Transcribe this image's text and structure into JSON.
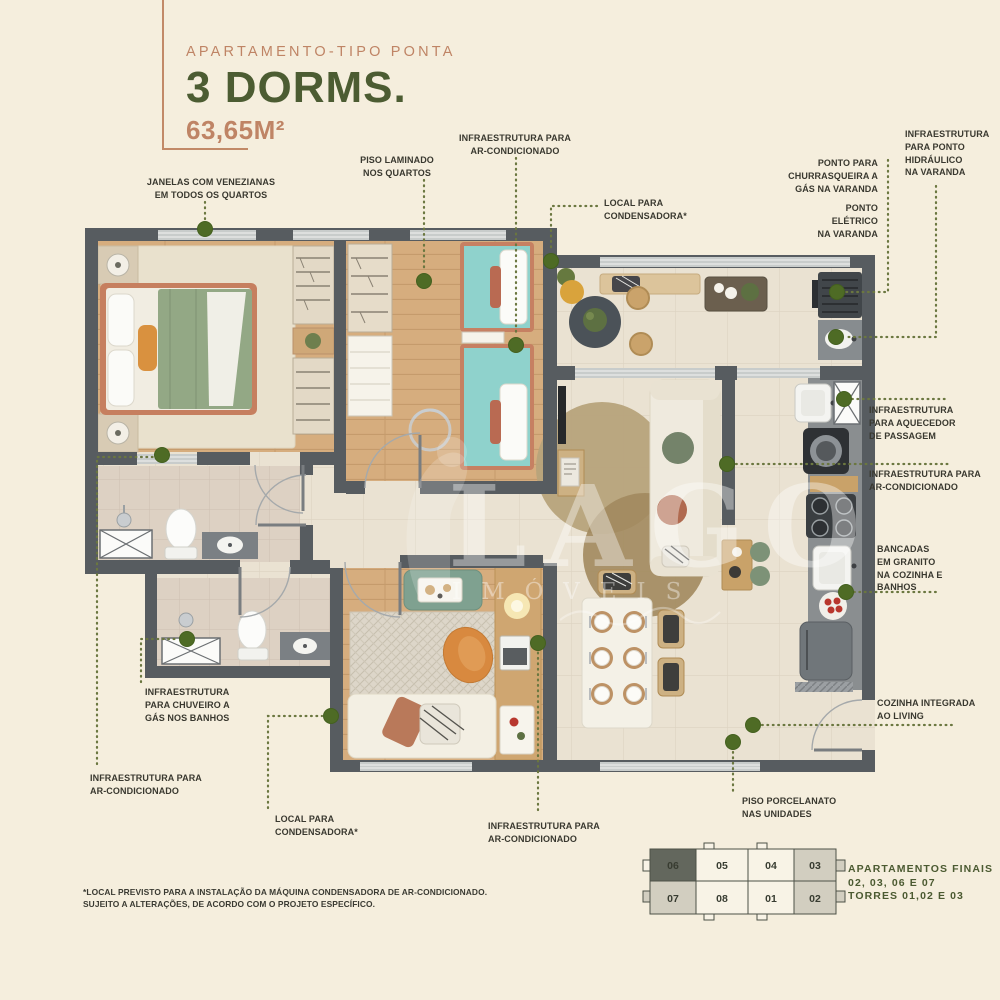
{
  "header": {
    "kicker": "APARTAMENTO-TIPO PONTA",
    "title": "3 DORMS.",
    "area": "63,65M²"
  },
  "callouts": {
    "janelas": {
      "lines": [
        "JANELAS COM VENEZIANAS",
        "EM TODOS OS QUARTOS"
      ]
    },
    "piso_laminado": {
      "lines": [
        "PISO LAMINADO",
        "NOS QUARTOS"
      ]
    },
    "infra_ar_top": {
      "lines": [
        "INFRAESTRUTURA PARA",
        "AR-CONDICIONADO"
      ]
    },
    "local_condensadora_top": {
      "lines": [
        "LOCAL PARA",
        "CONDENSADORA*"
      ]
    },
    "churrasqueira": {
      "lines": [
        "PONTO PARA",
        "CHURRASQUEIRA A",
        "GÁS NA VARANDA"
      ]
    },
    "ponto_eletrico": {
      "lines": [
        "PONTO",
        "ELÉTRICO",
        "NA VARANDA"
      ]
    },
    "hidraulico": {
      "lines": [
        "INFRAESTRUTURA",
        "PARA PONTO",
        "HIDRÁULICO",
        "NA VARANDA"
      ]
    },
    "aquecedor": {
      "lines": [
        "INFRAESTRUTURA",
        "PARA AQUECEDOR",
        "DE PASSAGEM"
      ]
    },
    "infra_ar_right": {
      "lines": [
        "INFRAESTRUTURA PARA",
        "AR-CONDICIONADO"
      ]
    },
    "bancadas": {
      "lines": [
        "BANCADAS",
        "EM GRANITO",
        "NA COZINHA E",
        "BANHOS"
      ]
    },
    "cozinha_integrada": {
      "lines": [
        "COZINHA INTEGRADA",
        "AO LIVING"
      ]
    },
    "piso_porcelanato": {
      "lines": [
        "PISO PORCELANATO",
        "NAS UNIDADES"
      ]
    },
    "chuveiro": {
      "lines": [
        "INFRAESTRUTURA",
        "PARA CHUVEIRO A",
        "GÁS NOS BANHOS"
      ]
    },
    "infra_ar_left": {
      "lines": [
        "INFRAESTRUTURA PARA",
        "AR-CONDICIONADO"
      ]
    },
    "local_condensadora_bottom": {
      "lines": [
        "LOCAL PARA",
        "CONDENSADORA*"
      ]
    },
    "infra_ar_bottom": {
      "lines": [
        "INFRAESTRUTURA PARA",
        "AR-CONDICIONADO"
      ]
    }
  },
  "keyplan": {
    "units": [
      {
        "number": "06",
        "shade": "dark"
      },
      {
        "number": "05",
        "shade": "white"
      },
      {
        "number": "04",
        "shade": "white"
      },
      {
        "number": "03",
        "shade": "light"
      },
      {
        "number": "07",
        "shade": "light"
      },
      {
        "number": "08",
        "shade": "white"
      },
      {
        "number": "01",
        "shade": "white"
      },
      {
        "number": "02",
        "shade": "light"
      }
    ],
    "caption_lines": [
      "APARTAMENTOS FINAIS",
      "02, 03, 06 E 07",
      "TORRES 01,02 E 03"
    ]
  },
  "footnote": {
    "lines": [
      "*LOCAL PREVISTO PARA A INSTALAÇÃO DA MÁQUINA CONDENSADORA DE AR-CONDICIONADO.",
      "SUJEITO A ALTERAÇÕES, DE ACORDO COM O PROJETO ESPECÍFICO."
    ]
  },
  "watermark": {
    "title": "LAGO",
    "subtitle": "IMÓVEIS"
  },
  "colors": {
    "background": "#f5eedd",
    "accent_salmon": "#bf8465",
    "accent_green": "#4c5c32",
    "label_text": "#39382f",
    "leader_line": "#6b7740",
    "leader_dot": "#4e6b25",
    "wall": "#575c60",
    "wood_floor": "#d6ad7e",
    "tile_floor": "#eae2d2"
  }
}
